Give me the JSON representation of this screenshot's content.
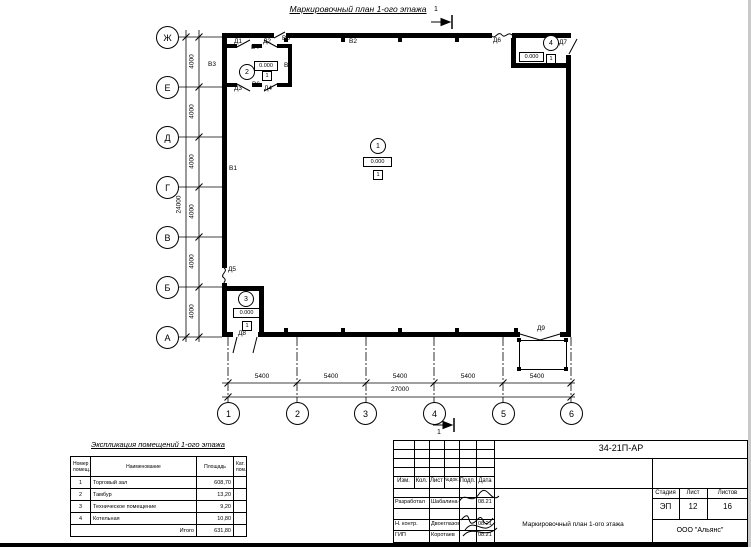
{
  "page": {
    "title": "Маркировочный план 1-ого этажа"
  },
  "plan": {
    "section_mark": "1",
    "row_axes": [
      "Ж",
      "Е",
      "Д",
      "Г",
      "В",
      "Б",
      "А"
    ],
    "col_axes": [
      "1",
      "2",
      "3",
      "4",
      "5",
      "6"
    ],
    "row_dim_labels": [
      "4000",
      "4000",
      "4000",
      "4000",
      "4000",
      "4000"
    ],
    "row_total_label": "24000",
    "col_dim_labels": [
      "5400",
      "5400",
      "5400",
      "5400",
      "5400"
    ],
    "col_total_label": "27000",
    "wall_labels": {
      "v1": "В1",
      "v2": "В2",
      "v3": "В3",
      "v4": "В4",
      "v5": "В5",
      "v6": "В6",
      "v7": "В7"
    },
    "door_labels": {
      "d1": "Д1",
      "d2": "Д2",
      "d3": "Д3",
      "d4": "Д4",
      "d5": "Д5",
      "d6": "Д6",
      "d7": "Д7",
      "d8": "Д8",
      "d9": "Д9"
    },
    "rooms": [
      {
        "num": "1",
        "elevation": "0.000",
        "floor_mark": "1"
      },
      {
        "num": "2",
        "elevation": "0.000",
        "floor_mark": "1"
      },
      {
        "num": "3",
        "elevation": "0.000",
        "floor_mark": "1"
      },
      {
        "num": "4",
        "elevation": "0.000",
        "floor_mark": "1"
      }
    ]
  },
  "explication": {
    "title": "Экспликация помещений 1-ого этажа",
    "col_headers": [
      "Номер помещ.",
      "Наименование",
      "Площадь",
      "Кат. пом."
    ],
    "rows": [
      {
        "num": "1",
        "name": "Торговый зал",
        "area": "608,70"
      },
      {
        "num": "2",
        "name": "Тамбур",
        "area": "13,20"
      },
      {
        "num": "3",
        "name": "Техническое помещение",
        "area": "9,20"
      },
      {
        "num": "4",
        "name": "Котельная",
        "area": "10,80"
      }
    ],
    "total_label": "Итого",
    "total_area": "631,80"
  },
  "titleblock": {
    "code": "34-21П-АР",
    "header_cols": [
      "Изм.",
      "Кол.",
      "Лист",
      "№док.",
      "Подп.",
      "Дата"
    ],
    "sign_rows": [
      {
        "role": "Разработал",
        "name": "Шабалина",
        "date": "08.21"
      },
      {
        "role": "Н. контр.",
        "name": "Двоеглазов",
        "date": "08.21"
      },
      {
        "role": "ГИП",
        "name": "Коротаев",
        "date": "08.21"
      }
    ],
    "stage_label": "Стадия",
    "sheet_label": "Лист",
    "sheets_label": "Листов",
    "stage": "ЭП",
    "sheet": "12",
    "sheets": "16",
    "doc_name": "Маркировочный план 1-ого этажа",
    "company": "ООО \"Альянс\""
  }
}
